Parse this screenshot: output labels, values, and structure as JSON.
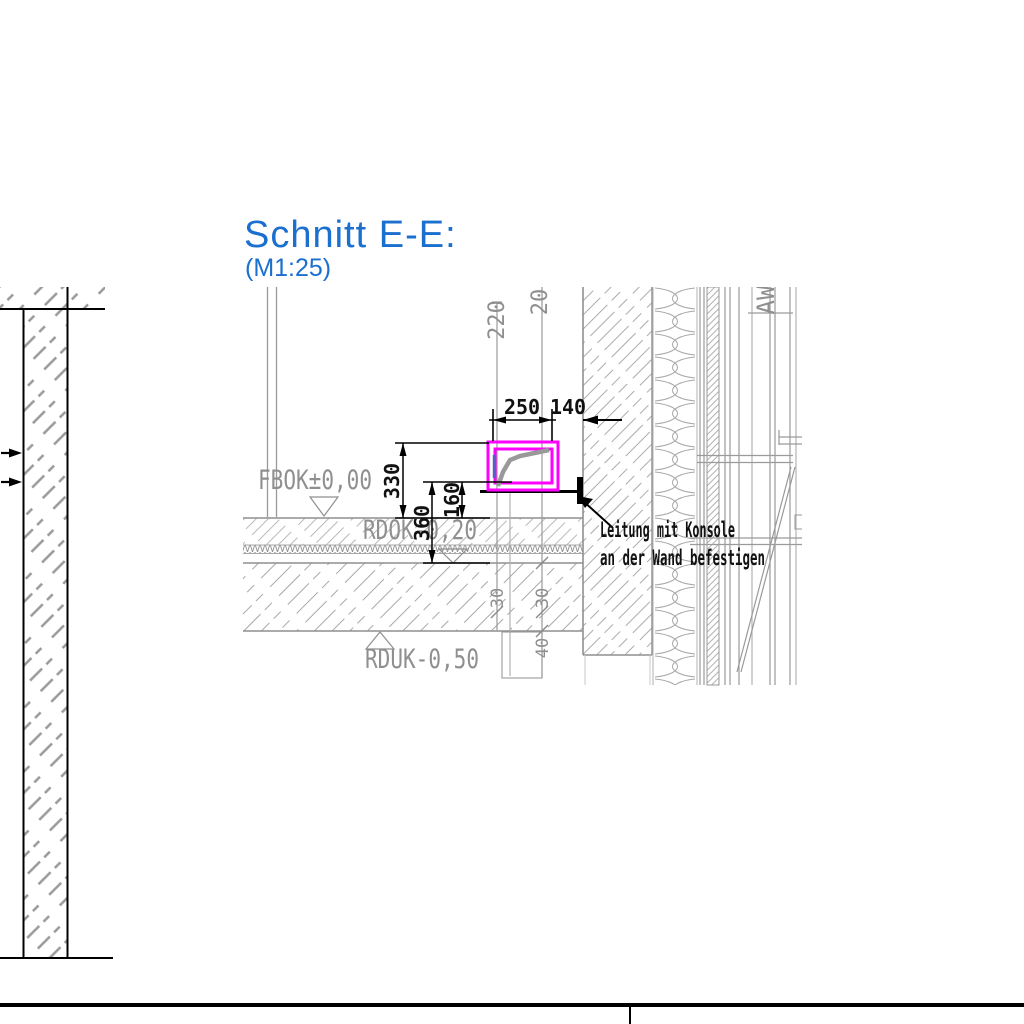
{
  "title": {
    "text": "Schnitt E-E:",
    "scale": "(M1:25)"
  },
  "levels": {
    "fbok": "FBOK±0,00",
    "rdok": "RDOK-0,20",
    "rduk": "RDUK-0,50"
  },
  "dimensions": {
    "width_duct": "250",
    "gap_wall": "140",
    "h_top": "330",
    "h_mid": "160",
    "h_slab": "360",
    "v_left": "220",
    "v_right": "20",
    "s30a": "30",
    "s30b": "30",
    "s40": "40"
  },
  "annotation": {
    "line1": "Leitung mit Konsole",
    "line2": "an der Wand befestigen"
  },
  "labels": {
    "wall_tag": "AW"
  },
  "colors": {
    "title_blue": "#1b6fce",
    "duct_magenta": "#ff00ff",
    "cad_gray": "#8f8f8f",
    "annotation_black": "#000000",
    "cable_gray": "#999999",
    "cable_blue": "#5b5bcc"
  }
}
